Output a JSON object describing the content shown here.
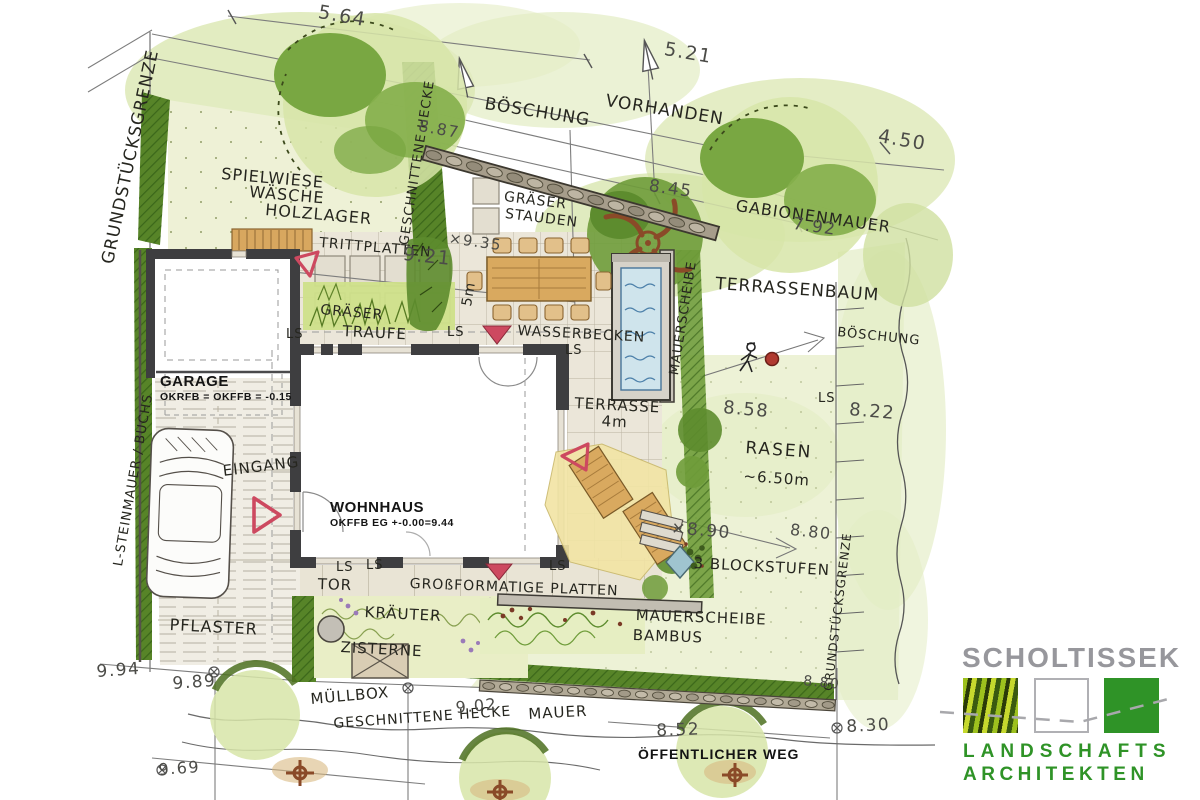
{
  "plan": {
    "type": "landscape-architecture-site-plan",
    "labels": {
      "boundary_left": "GRUNDSTÜCKSGRENZE",
      "boundary_right": "GRUNDSTÜCKSGRENZE",
      "hecke_top_vertical": "GESCHNITTENE HECKE",
      "spielwiese_1": "SPIELWIESE",
      "spielwiese_2": "WÄSCHE",
      "spielwiese_3": "HOLZLAGER",
      "boeschung_top": "BÖSCHUNG",
      "vorhanden": "VORHANDEN",
      "gabionenmauer": "GABIONENMAUER",
      "terrassenbaum": "TERRASSENBAUM",
      "boeschung_right": "BÖSCHUNG",
      "trittplatten": "TRITTPLATTEN",
      "graeser_upper": "GRÄSER",
      "stauden": "STAUDEN",
      "graeser_band": "GRÄSER",
      "traufe": "TRAUFE",
      "wasserbecken": "WASSERBECKEN",
      "mauerscheibe_vertical": "MAUERSCHEIBE",
      "eingang": "EINGANG",
      "terrasse": "TERRASSE",
      "terrasse_width": "4m",
      "rasen": "RASEN",
      "rasen_width": "~6.50m",
      "blockstufen": "3 BLOCKSTUFEN",
      "mauerscheibe_2": "MAUERSCHEIBE",
      "bambus": "BAMBUS",
      "tor": "TOR",
      "platten": "GROßFORMATIGE PLATTEN",
      "kraeuter": "KRÄUTER",
      "zisterne": "ZISTERNE",
      "pflaster": "PFLASTER",
      "l_steinmauer": "L-STEINMAUER / BUCHS",
      "muellbox": "MÜLLBOX",
      "hecke_bottom": "GESCHNITTENE HECKE",
      "mauer": "MAUER",
      "weg": "ÖFFENTLICHER WEG",
      "ls": "LS",
      "fuenf_m": "5m"
    },
    "buildings": {
      "garage_title": "GARAGE",
      "garage_level": "OKRFB = OKFFB = -0.15",
      "wohnhaus_title": "WOHNHAUS",
      "wohnhaus_level": "OKFFB EG +-0.00=9.44"
    },
    "dimensions": {
      "d9_21": "9.21",
      "d5_64": "5.64",
      "d5_21": "5.21",
      "d4_50": "4.50",
      "d8_87": "8.87",
      "d8_45": "8.45",
      "d7_92": "7.92",
      "d9_35": "×9.35",
      "d8_58": "8.58",
      "d8_22": "8.22",
      "d8_90": "×8.90",
      "d8_80": "8.80",
      "d8_80b": "8.80",
      "d9_94": "9.94",
      "d9_89": "9.89",
      "d9_02": "9.02",
      "d8_52": "8.52",
      "d8_30": "8.30",
      "d9_69": "9.69"
    }
  },
  "logo": {
    "name": "SCHOLTISSEK",
    "line1": "LANDSCHAFTS",
    "line2": "ARCHITEKTEN",
    "green": "#2f9327",
    "gray": "#97979c"
  },
  "colors": {
    "marker_red": "#cd4960",
    "water_blue": "#cfe4ec",
    "hedge_green": "#578428",
    "canopy_green": "#79a742",
    "wash_green": "#dbe7b2",
    "wall_dark": "#3e3e40",
    "wood": "#d9a95f",
    "stone": "#a69d8b",
    "paper": "#ffffff"
  }
}
